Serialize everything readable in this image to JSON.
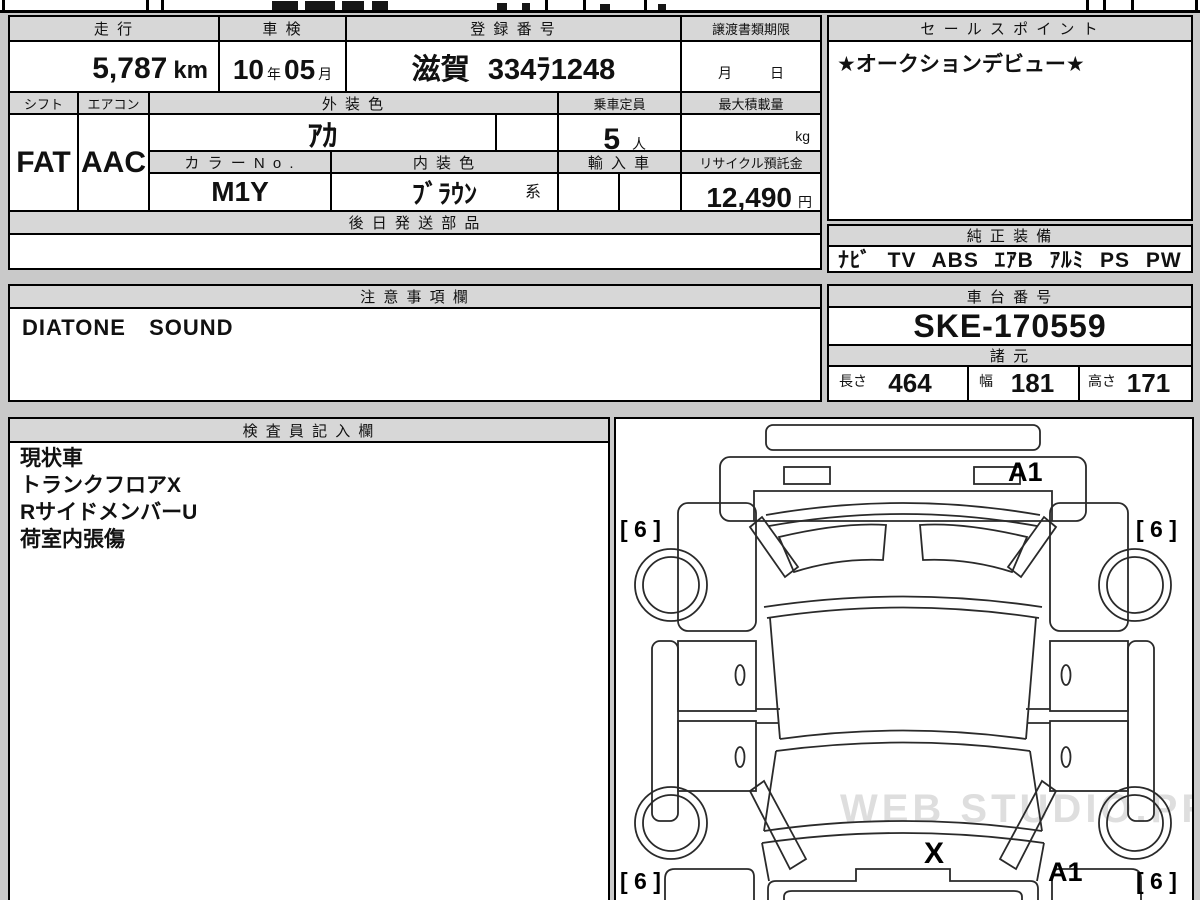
{
  "document": {
    "top_row1": {
      "mileage_header": "走 行",
      "inspection_header": "車 検",
      "registration_header": "登 録 番 号",
      "deadline_header": "譲渡書類期限",
      "mileage_value": "5,787",
      "mileage_unit": "km",
      "inspection_year": "10",
      "inspection_year_suffix": "年",
      "inspection_month": "05",
      "inspection_month_suffix": "月",
      "registration_value": "滋賀 334ﾗ1248",
      "deadline_month": "月",
      "deadline_day": "日"
    },
    "row2": {
      "shift_header": "シフト",
      "aircon_header": "エアコン",
      "exterior_header": "外 装 色",
      "capacity_header": "乗車定員",
      "maxload_header": "最大積載量",
      "shift_value": "FAT",
      "aircon_value": "AAC",
      "exterior_value": "ｱｶ",
      "capacity_value": "5",
      "capacity_unit": "人",
      "maxload_unit": "kg"
    },
    "row3": {
      "colorno_header": "カ ラ ー N o .",
      "interior_header": "内 装 色",
      "import_header": "輸 入 車",
      "recycle_header": "リサイクル預託金",
      "colorno_value": "M1Y",
      "interior_value": "ﾌﾞﾗｳﾝ",
      "interior_suffix": "系",
      "recycle_value": "12,490",
      "recycle_unit": "円"
    },
    "later_parts_header": "後 日 発 送 部 品",
    "sales_point": {
      "header": "セ ー ル ス ポ イ ン ト",
      "value": "★オークションデビュー★"
    },
    "equipment": {
      "header": "純 正 装 備",
      "value": "ﾅﾋﾞ TV ABS ｴｱB ｱﾙﾐ PS PW"
    },
    "cautions": {
      "header": "注 意 事 項 欄",
      "value": "DIATONE SOUND"
    },
    "chassis": {
      "header": "車 台 番 号",
      "value": "SKE-170559"
    },
    "specs": {
      "header": "諸 元",
      "length_label": "長さ",
      "length_value": "464",
      "width_label": "幅",
      "width_value": "181",
      "height_label": "高さ",
      "height_value": "171"
    },
    "inspector": {
      "header": "検 査 員 記 入 欄",
      "line1": "現状車",
      "line2": "トランクフロアX",
      "line3": "RサイドメンバーU",
      "line4": "荷室内張傷"
    },
    "diagram": {
      "mark_rear": "A1",
      "mark_front": "A1",
      "mark_hood": "X",
      "tire_top_left": "[ 6 ]",
      "tire_top_right": "[ 6 ]",
      "tire_bottom_left": "[ 6 ]",
      "tire_bottom_right": "[ 6 ]",
      "watermark": "WEB STUDIO.PRO"
    }
  }
}
